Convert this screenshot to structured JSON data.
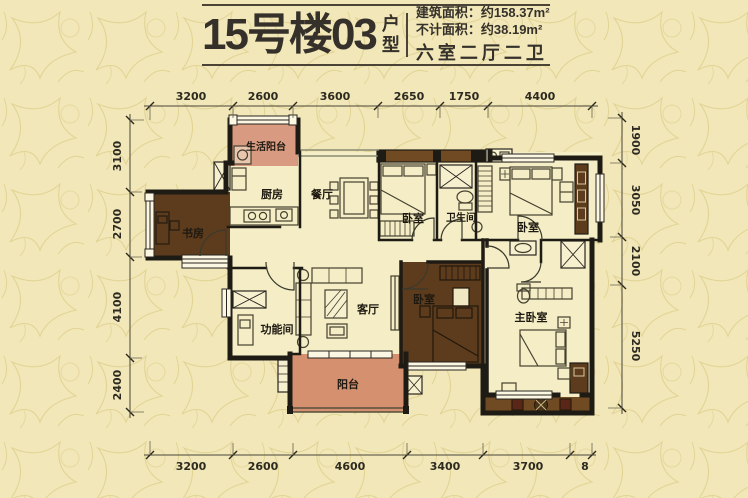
{
  "header": {
    "title": "15号楼03",
    "title_suffix": "户型",
    "area_line1": "建筑面积：约158.37m²",
    "area_line2": "不计面积：约38.19m²",
    "layout_line": "六室二厅二卫"
  },
  "rooms": {
    "service_balcony": "生活阳台",
    "kitchen": "厨房",
    "dining": "餐厅",
    "study": "书房",
    "bedroom1": "卧室",
    "bathroom": "卫生间",
    "bedroom2": "卧室",
    "function_room": "功能间",
    "living": "客厅",
    "bedroom3": "卧室",
    "balcony": "阳台",
    "master_bedroom": "主卧室"
  },
  "dimensions": {
    "top": [
      "3200",
      "2600",
      "3600",
      "2650",
      "1750",
      "4400"
    ],
    "bottom": [
      "3200",
      "2600",
      "4600",
      "3400",
      "3700",
      "8"
    ],
    "left": [
      "3100",
      "2700",
      "4100",
      "2400"
    ],
    "right": [
      "1900",
      "3050",
      "2100",
      "5250"
    ]
  },
  "colors": {
    "background": "#f1e7b8",
    "pattern": "#e2d193",
    "room_fill": "#f4edc6",
    "balcony_pink": "#d4906f",
    "dark_brown": "#5d3b1d",
    "terrace_brown": "#6f4a22",
    "wall": "#1e1b15",
    "text_dark": "#35312a"
  }
}
